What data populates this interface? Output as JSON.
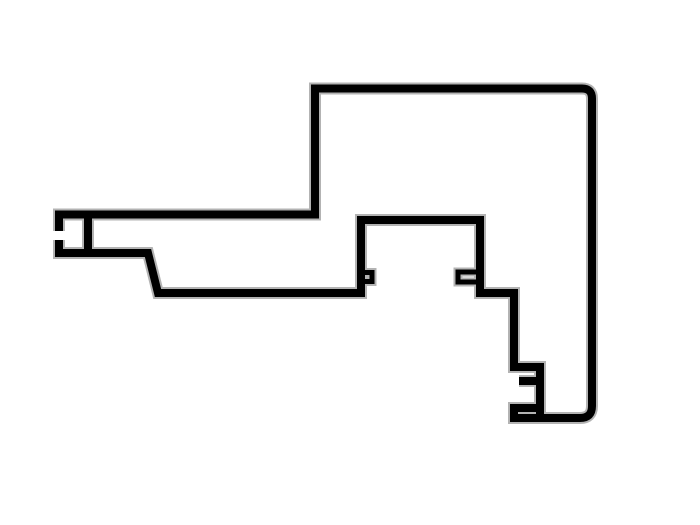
{
  "canvas": {
    "width": "700",
    "height": "525",
    "viewbox": "0 0 700 525",
    "background": "#ffffff"
  },
  "colors": {
    "ink": "#000000",
    "halo": "#b3b3b3",
    "paper": "#ffffff"
  },
  "strokes": {
    "main": "8",
    "main_halo": "12",
    "tab": "5",
    "tab_halo": "9"
  },
  "svg": {
    "paths": {
      "outer_outline": "M 59 231 L 59 214.5 L 315 214.5 L 315 88.5 L 582 88.5 Q 592 88.5 592 98.5 L 592 406 Q 592 418 580 418 L 514 418 L 514 408 L 536 408",
      "inner_run": "M 540 418 L 540 367 L 514 367 L 514 293 L 480 293 L 480 220 L 361 220 L 361 293 L 158 293 L 148 253 L 59 253 L 59 240",
      "channel_divider": "M 88 214.5 L 88 253",
      "gasket_tab_left": "M 364 272.5 L 372 272.5 L 372 281.5 L 364 281.5",
      "gasket_tab_right": "M 476 272 L 458 272 L 458 282 L 476 282",
      "slot_top_stub": "M 540 381 L 519 381"
    }
  }
}
